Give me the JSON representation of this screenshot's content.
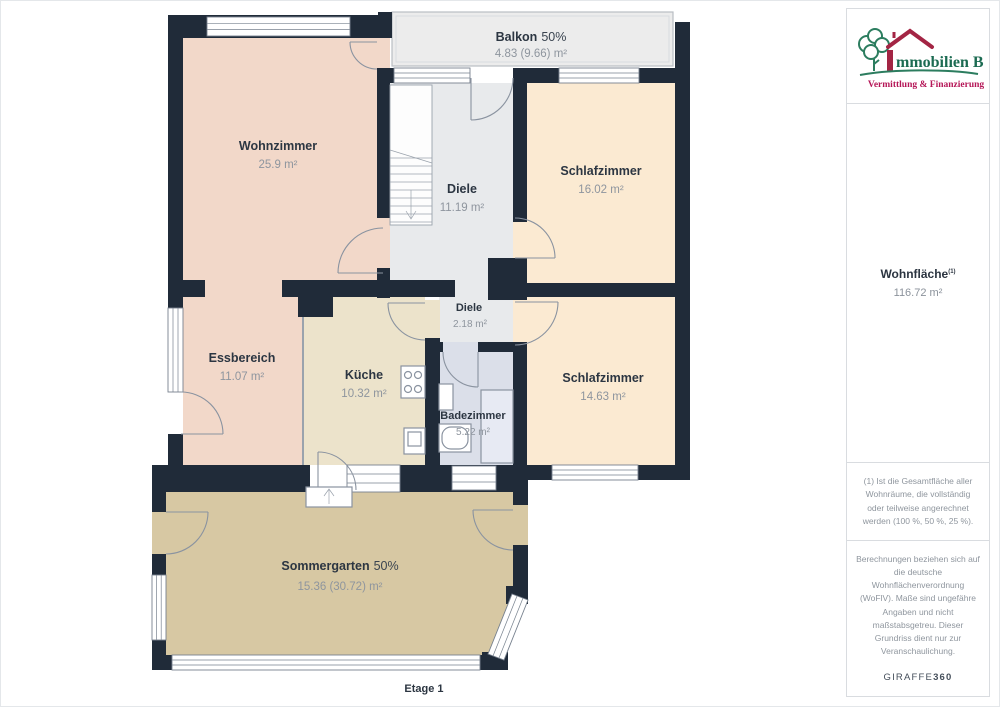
{
  "plan": {
    "floor_label": "Etage 1",
    "rooms": [
      {
        "id": "balkon",
        "name": "Balkon",
        "share": "50%",
        "area": "4.83 (9.66) m²"
      },
      {
        "id": "wohnzimmer",
        "name": "Wohnzimmer",
        "area": "25.9 m²"
      },
      {
        "id": "diele",
        "name": "Diele",
        "area": "11.19 m²"
      },
      {
        "id": "schlafzimmer1",
        "name": "Schlafzimmer",
        "area": "16.02 m²"
      },
      {
        "id": "diele2",
        "name": "Diele",
        "area": "2.18 m²"
      },
      {
        "id": "essbereich",
        "name": "Essbereich",
        "area": "11.07 m²"
      },
      {
        "id": "kueche",
        "name": "Küche",
        "area": "10.32 m²"
      },
      {
        "id": "badezimmer",
        "name": "Badezimmer",
        "area": "5.22 m²"
      },
      {
        "id": "schlafzimmer2",
        "name": "Schlafzimmer",
        "area": "14.63 m²"
      },
      {
        "id": "sommergarten",
        "name": "Sommergarten",
        "share": "50%",
        "area": "15.36 (30.72) m²"
      }
    ],
    "colors": {
      "wall": "#202b39",
      "wohnzimmer": "#f2d8c9",
      "essbereich": "#f2d8c9",
      "schlafzimmer": "#fbead2",
      "kueche": "#ece3cb",
      "diele": "#e8eaec",
      "badezimmer": "#dbdfe9",
      "sommergarten": "#d7c8a3",
      "balkon": "#ececec",
      "white": "#ffffff"
    }
  },
  "sidebar": {
    "logo": {
      "brand_i": "I",
      "brand_rest": "mmobilien Bart",
      "tagline": "Vermittlung & Finanzierung",
      "brand_green": "#1c6b52",
      "brand_red": "#a32544",
      "tagline_red": "#b51657"
    },
    "area_label": "Wohnfläche",
    "area_sup": "(1)",
    "area_value": "116.72 m²",
    "footnote": "(1) Ist die Gesamtfläche aller Wohnräume, die vollständig oder teilweise angerechnet werden (100 %, 50 %, 25 %).",
    "disclaimer": "Berechnungen beziehen sich auf die deutsche Wohnflächenverordnung (WoFlV). Maße sind ungefähre Angaben und nicht maßstabsgetreu. Dieser Grundriss dient nur zur Veranschaulichung.",
    "watermark_brand": "GIRAFFE",
    "watermark_num": "360"
  }
}
